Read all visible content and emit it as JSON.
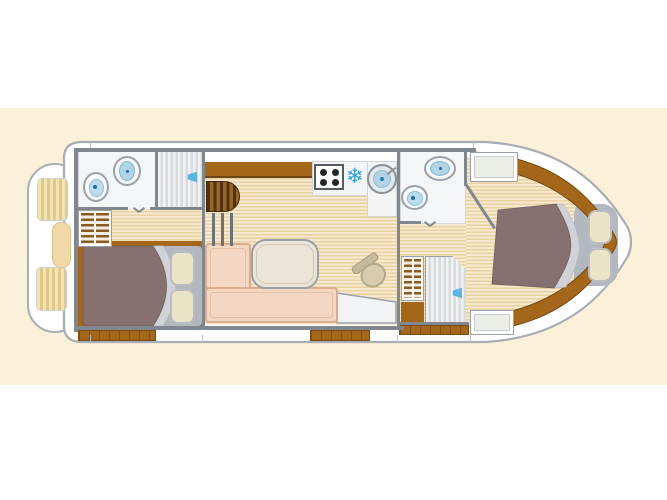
{
  "page": {
    "title": "Boat deck floorplan",
    "background": "#ffffff",
    "band_color": "#fbf0d8"
  },
  "palette": {
    "hull": "#ffffff",
    "hull_outline": "#a7adb4",
    "wood_trim": "#a4671a",
    "wall": "#81878f",
    "floor_light": "#f7ead0",
    "floor_dark": "#e9d1a2",
    "duvet": "#867170",
    "sheet_fold": "#cfd3d8",
    "pillow": "#eae3c6",
    "sofa": "#f3d7c3",
    "water_blue": "#2aa2da"
  },
  "boat": {
    "stern_deck": {
      "name": "aft sun deck",
      "cushions": [
        "striped pad",
        "center cushion",
        "striped pad"
      ]
    },
    "aft_bathroom": {
      "name": "aft bathroom",
      "fixtures": [
        "toilet",
        "washbasin",
        "shower"
      ]
    },
    "aft_cabin": {
      "name": "aft cabin",
      "furniture": [
        "wardrobe shelves",
        "double bed",
        "pillows"
      ]
    },
    "saloon": {
      "name": "saloon",
      "furniture": [
        "companionway steps",
        "handrail",
        "sideboard",
        "L-sofa",
        "table",
        "helm seat",
        "helm console"
      ],
      "galley": {
        "name": "galley",
        "appliances": [
          "4-burner stove",
          "freezer",
          "round sink"
        ],
        "freezer_glyph": "❄"
      }
    },
    "fwd_bathroom": {
      "name": "forward bathroom",
      "fixtures": [
        "washbasin",
        "toilet",
        "shelf unit",
        "shower"
      ]
    },
    "fwd_cabin": {
      "name": "forward cabin",
      "furniture": [
        "wardrobe",
        "double bed",
        "pillows"
      ]
    }
  }
}
